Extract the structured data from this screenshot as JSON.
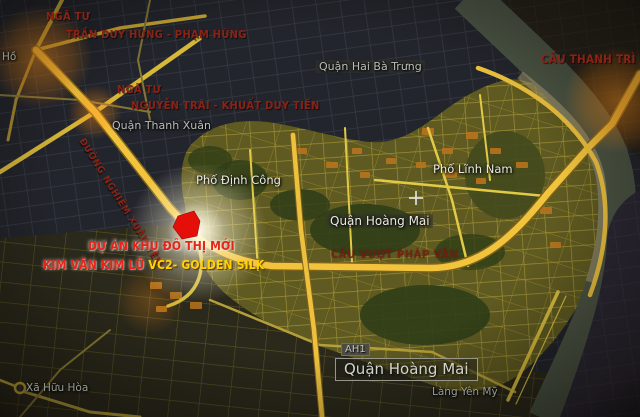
{
  "map": {
    "annotations": {
      "intersection_tdh": {
        "line1": "NGÃ TƯ",
        "line2": "TRẦN DUY HƯNG - PHẠM HÙNG"
      },
      "intersection_nt": {
        "line1": "NGÃ TƯ",
        "line2": "NGUYỄN TRÃI - KHUẤT DUY TIẾN"
      },
      "bridge_label": "CẦU THANH TRÌ",
      "road_label": "ĐƯỜNG NGHIÊM XUÂN YÊM",
      "overpass_label": "CẦU VƯỢT PHÁP VÂN",
      "project": {
        "line1": "DỰ ÁN KHU ĐÔ THỊ MỚI",
        "line2_red": "KIM VĂN KIM LŨ ",
        "line2_yellow": "VC2- GOLDEN SILK"
      }
    },
    "place_labels": {
      "ho": "Hồ",
      "quan_thanh_xuan": "Quận Thanh Xuân",
      "quan_hai_ba_trung": "Quận Hai Bà Trưng",
      "pho_dinh_cong": "Phố Định Công",
      "pho_linh_nam": "Phố Lĩnh Nam",
      "quan_hoang_mai": "Quận Hoàng Mai",
      "quan_hoang_mai_boxed": "Quận Hoàng Mai",
      "route_ah1": "AH1",
      "xa_huu_hoa": "Xã Hữu Hòa",
      "lang_yen_my": "Làng Yên Mỹ"
    },
    "colors": {
      "road_yellow": "#f2c43d",
      "annotation_red": "#8a2316",
      "project_red": "#e8241a",
      "project_yellow": "#ffd400",
      "site_red": "#e50f0a",
      "glow_orange": "#ff9820",
      "river": "#4b5444"
    }
  }
}
